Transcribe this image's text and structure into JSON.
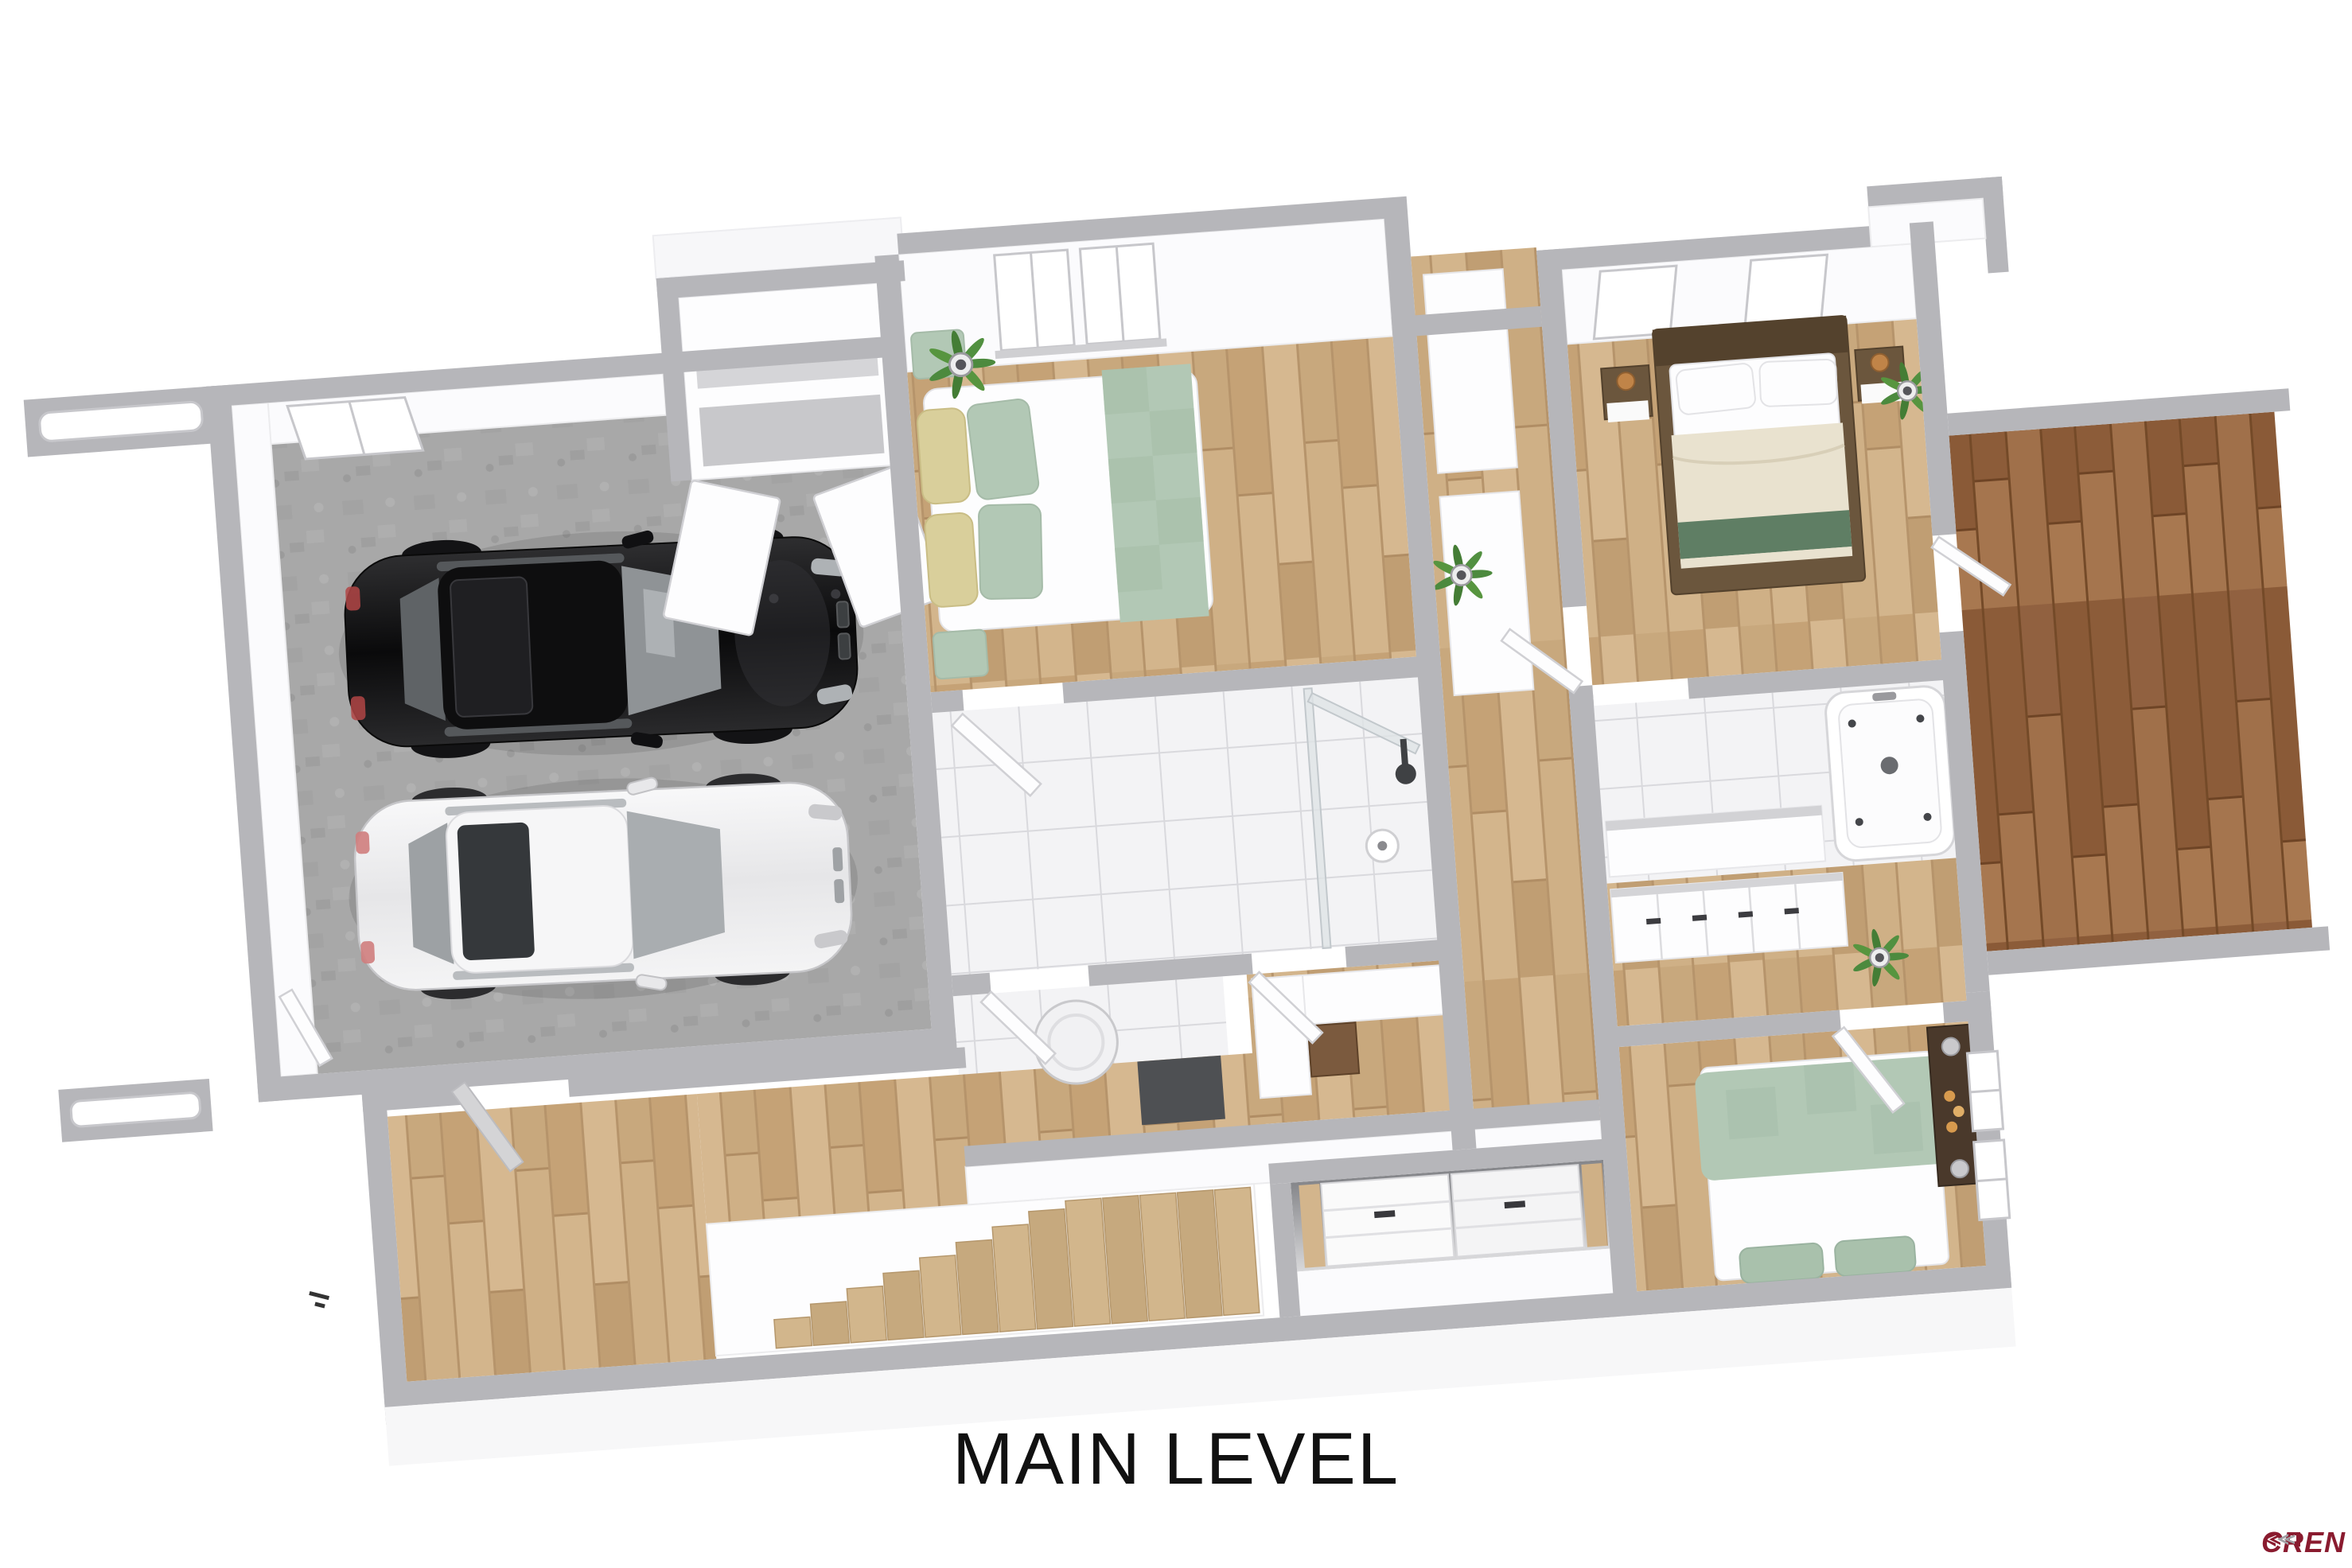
{
  "page": {
    "title": "MAIN LEVEL",
    "watermark": "CREN"
  },
  "colors": {
    "wall": "#b6b6ba",
    "wood": "#cdad83",
    "deck": "#9b6b45",
    "concrete": "#a8a8a8",
    "tile": "#f3f3f5",
    "accent_sage": "#b2c8b5",
    "accent_cream": "#e9e2cf",
    "accent_green": "#5f7e64",
    "dark_wood": "#4a392b",
    "car_black": "#141414",
    "car_white": "#ededee",
    "logo_maroon": "#8a1b2f",
    "logo_gray": "#a0a0a4",
    "text": "#111111"
  }
}
